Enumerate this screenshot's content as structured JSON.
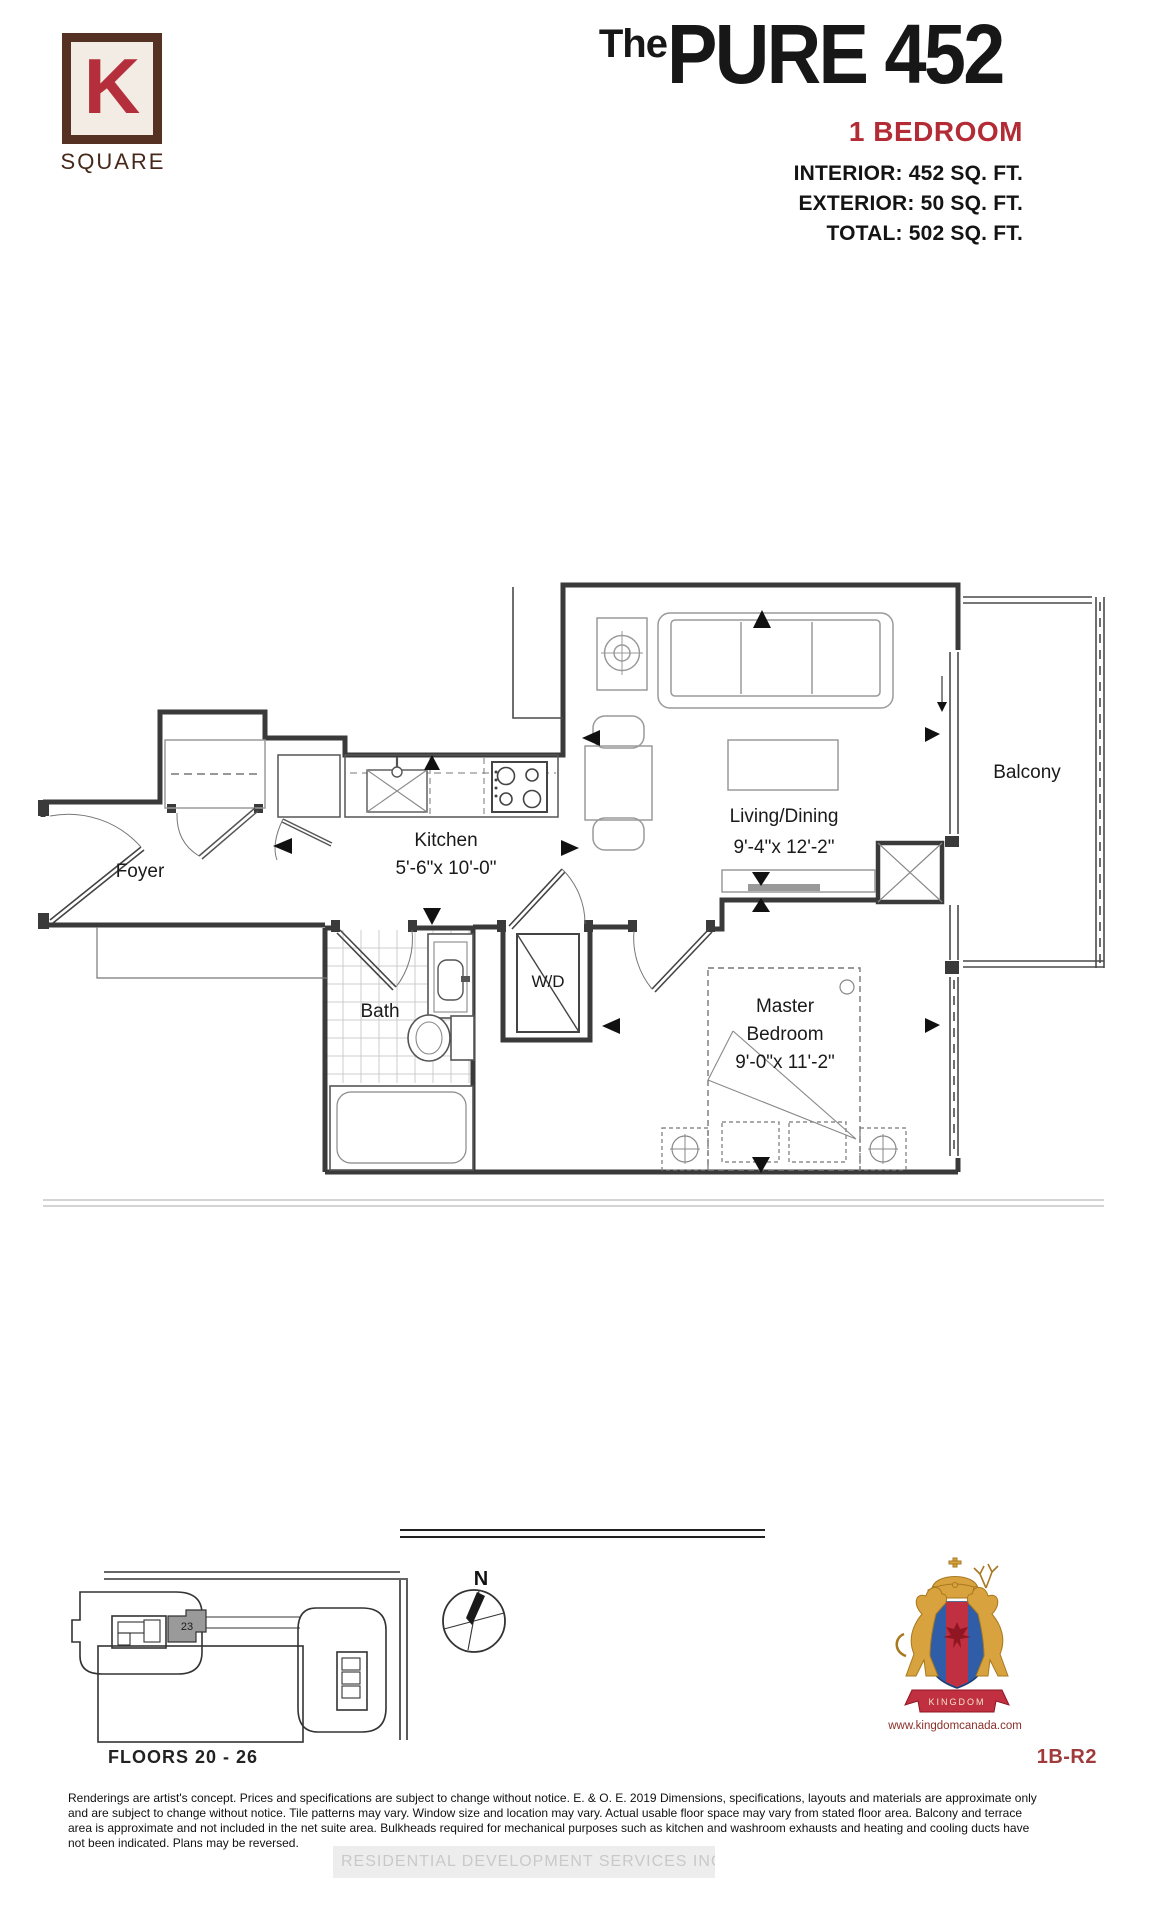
{
  "header": {
    "logo": {
      "letter": "K",
      "word": "SQUARE"
    },
    "title_prefix": "The",
    "title": "PURE 452",
    "subtitle": "1 BEDROOM",
    "specs": [
      "INTERIOR: 452 SQ. FT.",
      "EXTERIOR: 50 SQ. FT.",
      "TOTAL: 502 SQ. FT."
    ]
  },
  "plan": {
    "rooms": {
      "foyer": "Foyer",
      "kitchen": "Kitchen",
      "kitchen_dims": "5'-6\"x 10'-0\"",
      "living": "Living/Dining",
      "living_dims": "9'-4\"x 12'-2\"",
      "balcony": "Balcony",
      "bath": "Bath",
      "wd": "W/D",
      "master_1": "Master",
      "master_2": "Bedroom",
      "master_dims": "9'-0\"x 11'-2\""
    }
  },
  "footer": {
    "keyplan_unit": "23",
    "floors": "FLOORS 20 - 26",
    "compass_n": "N",
    "crest_banner": "KINGDOM",
    "website": "www.kingdomcanada.com",
    "unit_code": "1B-R2",
    "disclaimer": [
      "Renderings are artist's concept. Prices and specifications are subject to change without notice. E. & O. E. 2019 Dimensions, specifications, layouts and materials are approximate only",
      "and are subject to change without notice. Tile patterns may vary. Window size and location may vary. Actual usable floor space may vary from stated floor area. Balcony and terrace",
      "area is approximate and not included in the net suite area. Bulkheads required for mechanical purposes such as kitchen and washroom exhausts and heating and cooling ducts have",
      "not been indicated. Plans may be reversed."
    ],
    "watermark": "RESIDENTIAL DEVELOPMENT SERVICES INC., Brokerage"
  },
  "colors": {
    "accent_red": "#b32b35",
    "logo_brown": "#543122",
    "crest_gold": "#d8a33e",
    "crest_blue": "#2f5da8",
    "crest_red": "#c13040"
  }
}
